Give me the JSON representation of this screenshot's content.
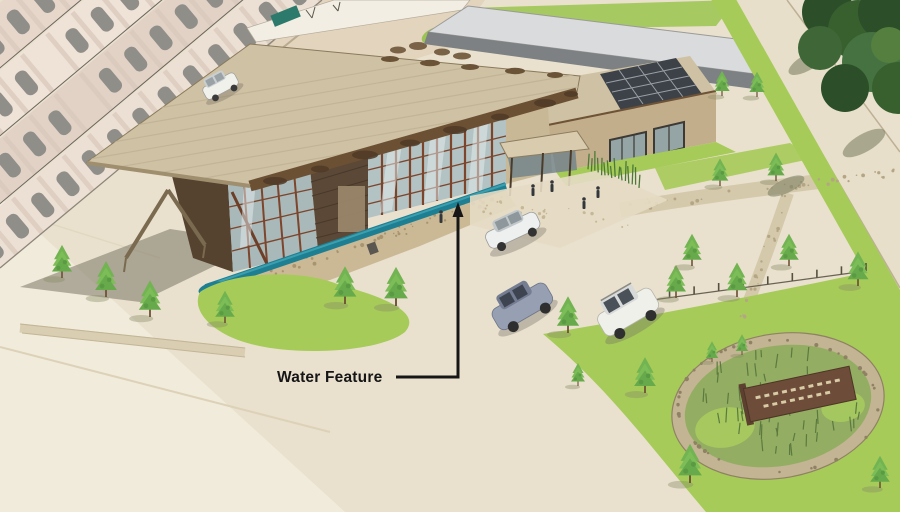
{
  "annotation": {
    "label": "Water Feature"
  },
  "palette": {
    "ground": "#e9e1ce",
    "ground_light": "#f1ebdb",
    "street": "#e2d4bd",
    "roof_tan": "#cfc1a3",
    "roof_fascia": "#6b5034",
    "wall_brown": "#5c4836",
    "glass": "#b3c2c2",
    "mullion_rust": "#7c452c",
    "stone": "#c9b896",
    "water": "#1e7f93",
    "grass": "#a6cb59",
    "tree_green": "#72b352",
    "tree_dark": "#2f5231",
    "warehouse_wall": "#7d8184",
    "warehouse_roof": "#d9dbdc",
    "solar_panel": "#3d4248",
    "sign_brown": "#6d4c39",
    "annotation_color": "#161616"
  }
}
